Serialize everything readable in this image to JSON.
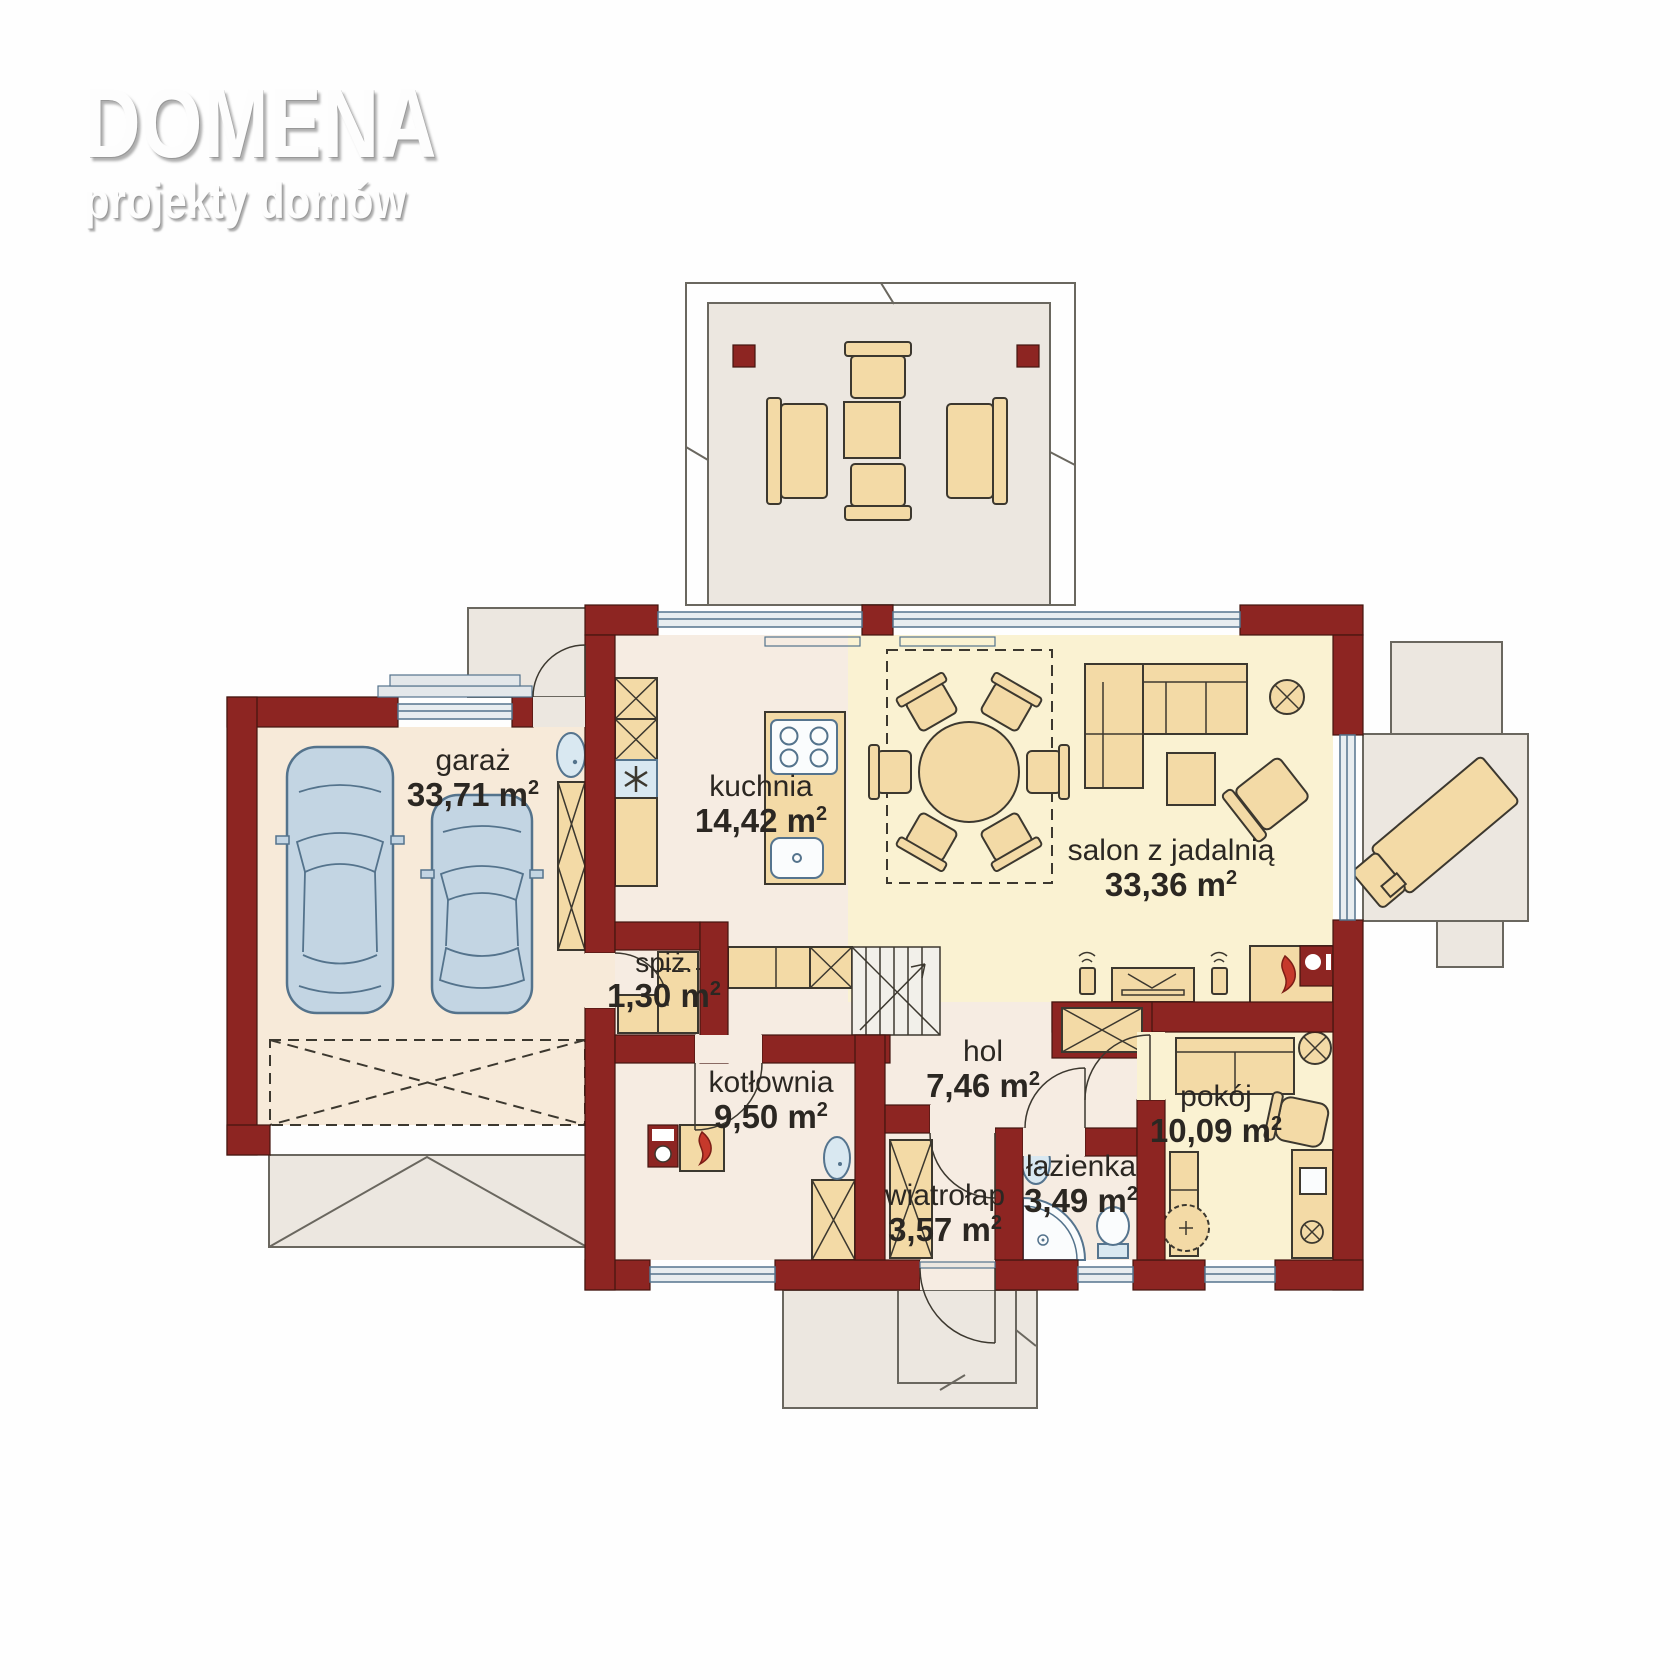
{
  "logo": {
    "title": "DOMENA",
    "subtitle": "projekty domów"
  },
  "units": {
    "m": "m",
    "sup": "2"
  },
  "rooms": [
    {
      "id": "garaz",
      "label": "garaż",
      "area": "33,71"
    },
    {
      "id": "kuchnia",
      "label": "kuchnia",
      "area": "14,42"
    },
    {
      "id": "salon",
      "label": "salon z jadalnią",
      "area": "33,36"
    },
    {
      "id": "spiz",
      "label": "spiż.",
      "area": "1,30"
    },
    {
      "id": "kotlownia",
      "label": "kotłownia",
      "area": "9,50"
    },
    {
      "id": "hol",
      "label": "hol",
      "area": "7,46"
    },
    {
      "id": "wiatrolap",
      "label": "wiatrołap",
      "area": "3,57"
    },
    {
      "id": "lazienka",
      "label": "łazienka",
      "area": "3,49"
    },
    {
      "id": "pokoj",
      "label": "pokój",
      "area": "10,09"
    }
  ],
  "colors": {
    "wall": "#8D2522",
    "floor-cream": "#F7EAD9",
    "floor-warm": "#F6ECE2",
    "floor-yellow": "#FAF2D2",
    "furniture": "#F3DAA6",
    "terrace": "#ECE7E0",
    "fixture": "#D9E8F1",
    "fixture-white": "#FAFCFD",
    "car": "#C3D5E3",
    "flame": "#C6392B",
    "line": "#3C382F",
    "sash": "#55748E",
    "stairs": "#F2F0EA"
  }
}
